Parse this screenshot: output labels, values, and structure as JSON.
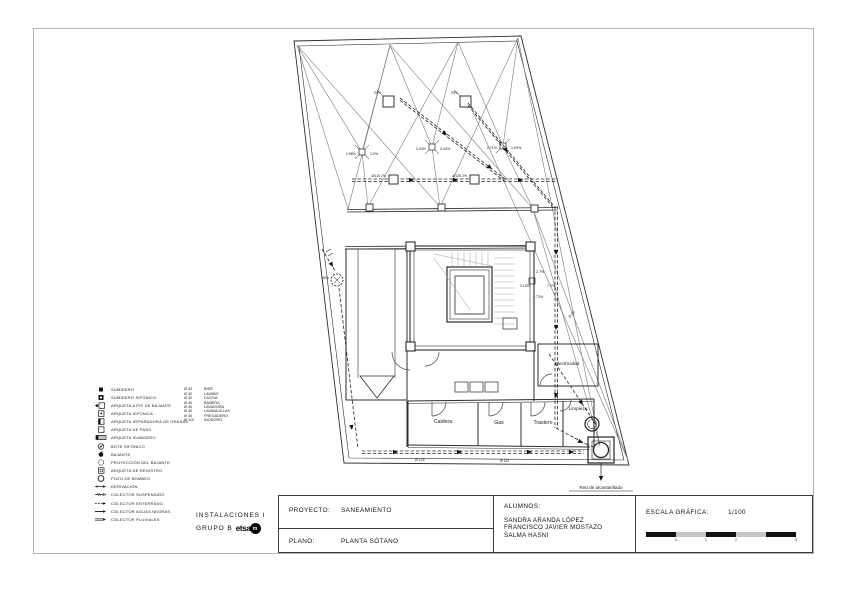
{
  "branding": {
    "course": "INSTALACIONES I",
    "group": "GRUPO B",
    "logo_text": "etsa",
    "logo_badge": "m"
  },
  "title_block": {
    "proyecto_label": "PROYECTO:",
    "proyecto_value": "SANEAMIENTO",
    "plano_label": "PLANO:",
    "plano_value": "PLANTA SÓTANO",
    "alumnos_label": "ALUMNOS:",
    "alumnos": [
      "SANDRA ARANDA LÓPEZ",
      "FRANCISCO JAVIER MOSTAZO",
      "SALMA HASNI"
    ],
    "escala_label": "ESCALA GRÁFICA:",
    "escala_value": "1/100",
    "scale_ticks": [
      "0",
      "1",
      "2",
      "5"
    ]
  },
  "legend": {
    "symbols": [
      {
        "icon": "sumidero",
        "label": "SUMIDERO"
      },
      {
        "icon": "sumidero-sifonico",
        "label": "SUMIDERO SIFÓNICO"
      },
      {
        "icon": "arqueta-pie-bajante",
        "label": "ARQUETA A PIE DE BAJANTE"
      },
      {
        "icon": "arqueta-sifonica",
        "label": "ARQUETA SIFÓNICA"
      },
      {
        "icon": "arqueta-separadora",
        "label": "ARQUETA SEPARADORA DE GRASAS"
      },
      {
        "icon": "arqueta-paso",
        "label": "ARQUETA DE PASO"
      },
      {
        "icon": "arqueta-sumidero",
        "label": "ARQUETA SUMIDERO"
      },
      {
        "icon": "bote-sifonico",
        "label": "BOTE SIFÓNICO"
      },
      {
        "icon": "bajante",
        "label": "BAJANTE"
      },
      {
        "icon": "proyeccion-bajante",
        "label": "PROYECCIÓN DEL BAJANTE"
      },
      {
        "icon": "arqueta-registro",
        "label": "ARQUETA DE REGISTRO"
      },
      {
        "icon": "pozo-bombeo",
        "label": "POZO DE BOMBEO"
      },
      {
        "icon": "derivacion",
        "label": "DERIVACIÓN"
      },
      {
        "icon": "colector-suspendido",
        "label": "COLECTOR SUSPENDIDO"
      },
      {
        "icon": "colector-enterrado",
        "label": "COLECTOR ENTERRADO"
      },
      {
        "icon": "colector-aguas-negras",
        "label": "COLECTOR AGUAS NEGRAS"
      },
      {
        "icon": "colector-pluviales",
        "label": "COLECTOR PLUVIALES"
      }
    ],
    "diameters": [
      {
        "size": "Ø 32",
        "fixture": "BIDÉ"
      },
      {
        "size": "Ø 32",
        "fixture": "LAVABO"
      },
      {
        "size": "Ø 40",
        "fixture": "DUCHA"
      },
      {
        "size": "Ø 40",
        "fixture": "BAÑERA"
      },
      {
        "size": "Ø 40",
        "fixture": "LAVADORA"
      },
      {
        "size": "Ø 40",
        "fixture": "LAVAVAJILLAS"
      },
      {
        "size": "Ø 40",
        "fixture": "FREGADERO"
      },
      {
        "size": "Ø 110",
        "fixture": "INODORO"
      }
    ]
  },
  "plan": {
    "rooms": [
      {
        "name": "Caldera"
      },
      {
        "name": "Gas"
      },
      {
        "name": "Trastero"
      },
      {
        "name": "Limpieza"
      },
      {
        "name": "Electricidad"
      }
    ],
    "slopes": [
      "2.98%",
      "2.0%",
      "3.44%",
      "3.44%",
      "2.71%",
      "1.09%",
      "2.7%",
      "3.10%",
      "7.2%",
      "1.73%"
    ],
    "pipe_notes": [
      "Ø110 2%",
      "Ø125 2%",
      "Ø 90",
      "Ø 125",
      "Ø 110"
    ],
    "node_labels": {
      "bp1": "BP1",
      "bp2": "BP2",
      "ar1": "AR1"
    },
    "sewer_label": "Red de alcantarillado"
  }
}
